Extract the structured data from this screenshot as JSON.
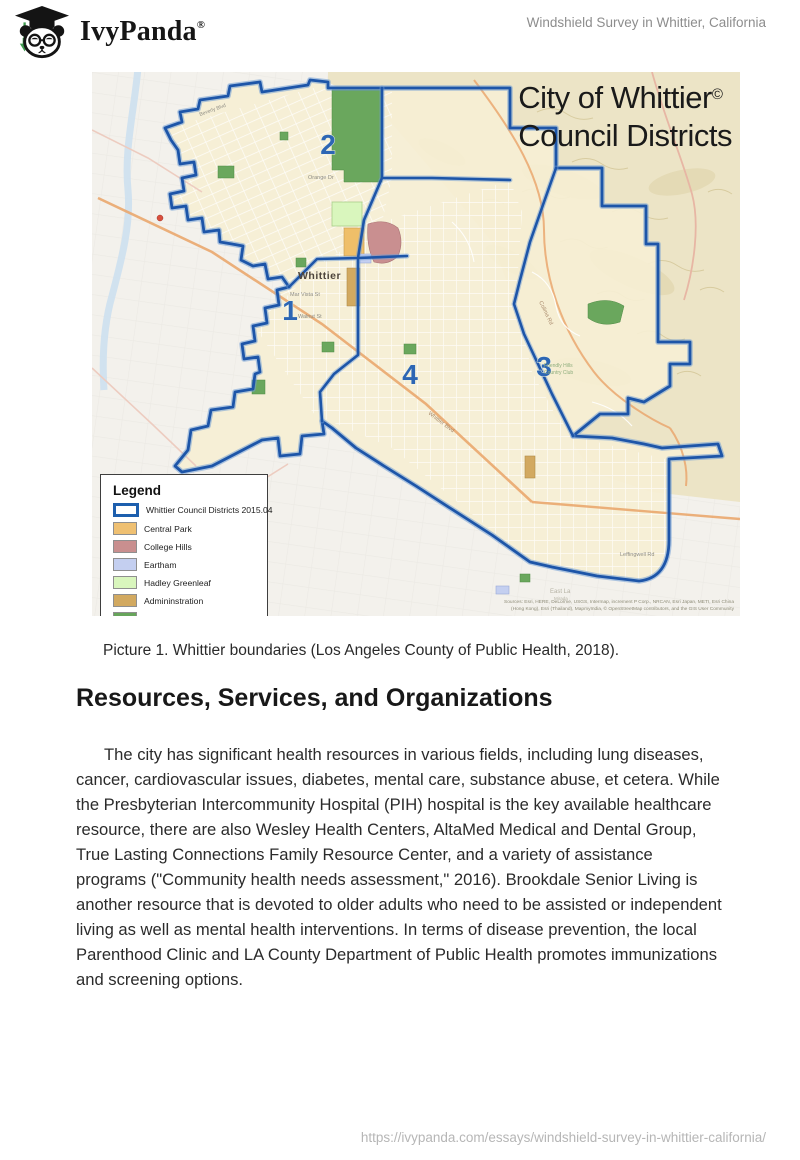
{
  "header": {
    "brand": "IvyPanda",
    "brand_mark": "®",
    "doc_title": "Windshield Survey in Whittier, California"
  },
  "map": {
    "title_line1": "City of Whittier",
    "title_mark": "©",
    "title_line2": "Council Districts",
    "city_label": "Whittier",
    "district_numbers": [
      "1",
      "2",
      "3",
      "4"
    ],
    "street_labels": [
      "Orange Dr",
      "Mar Vista St",
      "Walnut St",
      "Whittier Blvd",
      "Colima Rd",
      "Leffingwell Rd",
      "Friendly Hills",
      "Country Club",
      "East La",
      "Mirada",
      "Beverly Blvd"
    ],
    "attribution_line1": "Sources: Esri, HERE, DeLorme, USGS, Intermap, increment P Corp., NRCAN, Esri Japan, METI, Esri China",
    "attribution_line2": "(Hong Kong), Esri (Thailand), MapmyIndia, © OpenStreetMap contributors, and the GIS User Community",
    "legend": {
      "title": "Legend",
      "items": [
        {
          "label": "Whittier Council Districts 2015.04",
          "color": "#ffffff",
          "border": "#1d5fae"
        },
        {
          "label": "Central Park",
          "color": "#efc072"
        },
        {
          "label": "College Hills",
          "color": "#c98f8f"
        },
        {
          "label": "Eartham",
          "color": "#c4cff0"
        },
        {
          "label": "Hadley Greenleaf",
          "color": "#d9f6bd"
        },
        {
          "label": "Admininstration",
          "color": "#d2a960"
        },
        {
          "label": "Parks",
          "color": "#67a55b"
        }
      ]
    }
  },
  "figure_caption": "Picture 1. Whittier boundaries (Los Angeles County of Public Health, 2018).",
  "section_heading": "Resources, Services, and Organizations",
  "body_paragraph": "The city has significant health resources in various fields, including lung diseases, cancer, cardiovascular issues, diabetes, mental care, substance abuse, et cetera. While the Presbyterian Intercommunity Hospital (PIH) hospital is the key available healthcare resource, there are also Wesley Health Centers, AltaMed Medical and Dental Group, True Lasting Connections Family Resource Center, and a variety of assistance programs (\"Community health needs assessment,\" 2016). Brookdale Senior Living is another resource that is devoted to older adults who need to be assisted or independent living as well as mental health interventions. In terms of disease prevention, the local Parenthood Clinic and LA County Department of Public Health promotes immunizations and screening options.",
  "footer_url": "https://ivypanda.com/essays/windshield-survey-in-whittier-california/",
  "colors": {
    "boundary_blue": "#1d55a8",
    "district_number_blue": "#2d66b4",
    "city_fill": "#f6efd4",
    "hills_fill": "#ece4c6",
    "outside_fill": "#f3f1ec",
    "river_blue": "#cfe0ef",
    "road_orange": "#eaa76e"
  }
}
